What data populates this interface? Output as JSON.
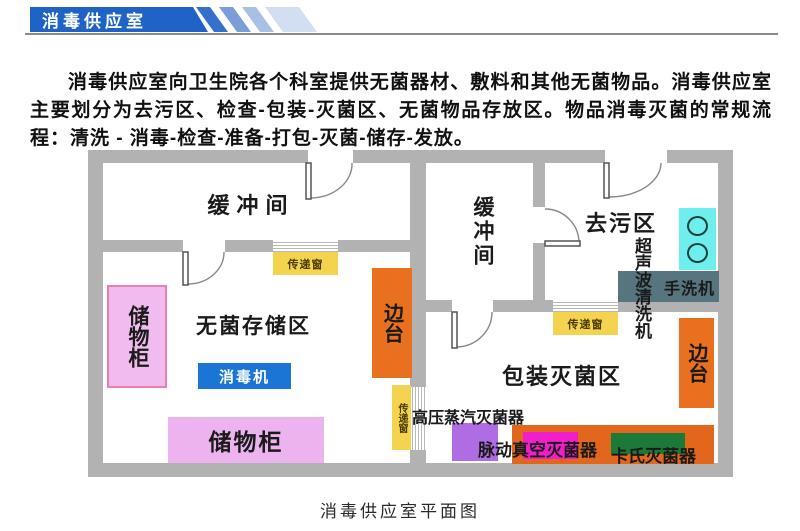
{
  "header": {
    "title": "消毒供应室"
  },
  "intro": {
    "text": "消毒供应室向卫生院各个科室提供无菌器材、敷料和其他无菌物品。消毒供应室主要划分为去污区、检查-包装-灭菌区、无菌物品存放区。物品消毒灭菌的常规流程：清洗 - 消毒-检查-准备-打包-灭菌-储存-发放。"
  },
  "plan": {
    "rooms": {
      "buffer_left": "缓冲间",
      "buffer_right": "缓冲间",
      "decontamination": "去污区",
      "sterile_storage": "无菌存储区",
      "packaging_sterilization": "包装灭菌区"
    },
    "equipment": {
      "cabinet_left": "储物柜",
      "cabinet_bottom": "储物柜",
      "disinfector": "消毒机",
      "side_table_left": "边台",
      "side_table_right": "边台",
      "pass_window_1": "传递窗",
      "pass_window_2": "传递窗",
      "pass_window_3": "传递窗",
      "ultrasonic_cleaner": "超声波清洗机",
      "hand_washer": "手洗机",
      "autoclave": "高压蒸汽灭菌器",
      "pulse_vacuum_sterilizer": "脉动真空灭菌器",
      "cassette_sterilizer": "卡氏灭菌器"
    }
  },
  "caption": "消毒供应室平面图",
  "colors": {
    "banner_blue": "#2063c6",
    "wall_gray": "#b2b2b2",
    "cabinet_pink": "#f0bcf0",
    "cabinet_border_pink": "#e87fae",
    "disinfector_blue": "#1a75d4",
    "side_table_orange": "#e8701e",
    "pass_window_yellow": "#f4d44f",
    "sink_cyan": "#6feeee",
    "hand_washer_slate": "#56757e",
    "autoclave_purple": "#b06ce2",
    "sterilizer_orange": "#e2661c",
    "pulse_vacuum_magenta": "#f31ecb",
    "cassette_green": "#1c7a39"
  }
}
